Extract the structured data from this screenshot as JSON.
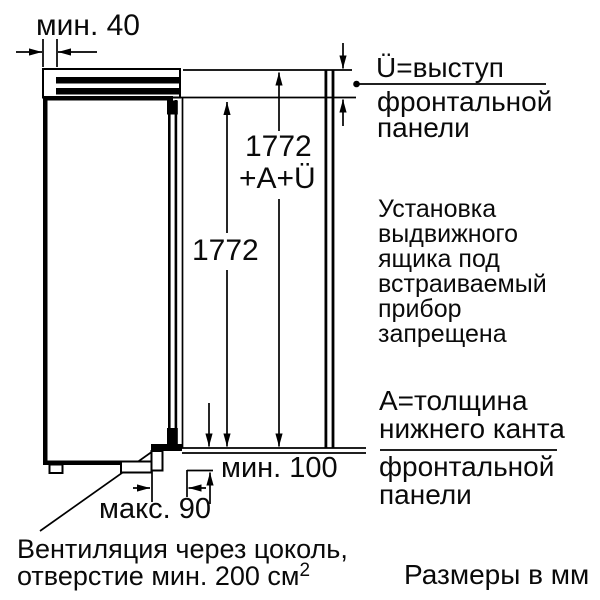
{
  "diagram": {
    "dimensions": {
      "top_gap": "мин. 40",
      "panel_height_value": "1772",
      "panel_height_suffix": "+A+Ü",
      "niche_height": "1772",
      "bottom_gap": "мин. 100",
      "plinth_recess": "макс. 90"
    },
    "annotations": {
      "overhang": {
        "lines": [
          "Ü=выступ",
          "фронтальной",
          "панели"
        ]
      },
      "drawer_warning": {
        "lines": [
          "Установка",
          "выдвижного",
          "ящика под",
          "встраиваемый",
          "прибор",
          "запрещена"
        ]
      },
      "bottom_edge": {
        "lines": [
          "A=толщина",
          "нижнего канта",
          "фронтальной",
          "панели"
        ]
      },
      "ventilation": {
        "line1": "Вентиляция через цоколь,",
        "line2": "отверстие мин. 200 см",
        "superscript": "2"
      }
    },
    "footer": {
      "units_note": "Размеры в мм"
    },
    "colors": {
      "line": "#000000",
      "background": "#ffffff"
    }
  }
}
